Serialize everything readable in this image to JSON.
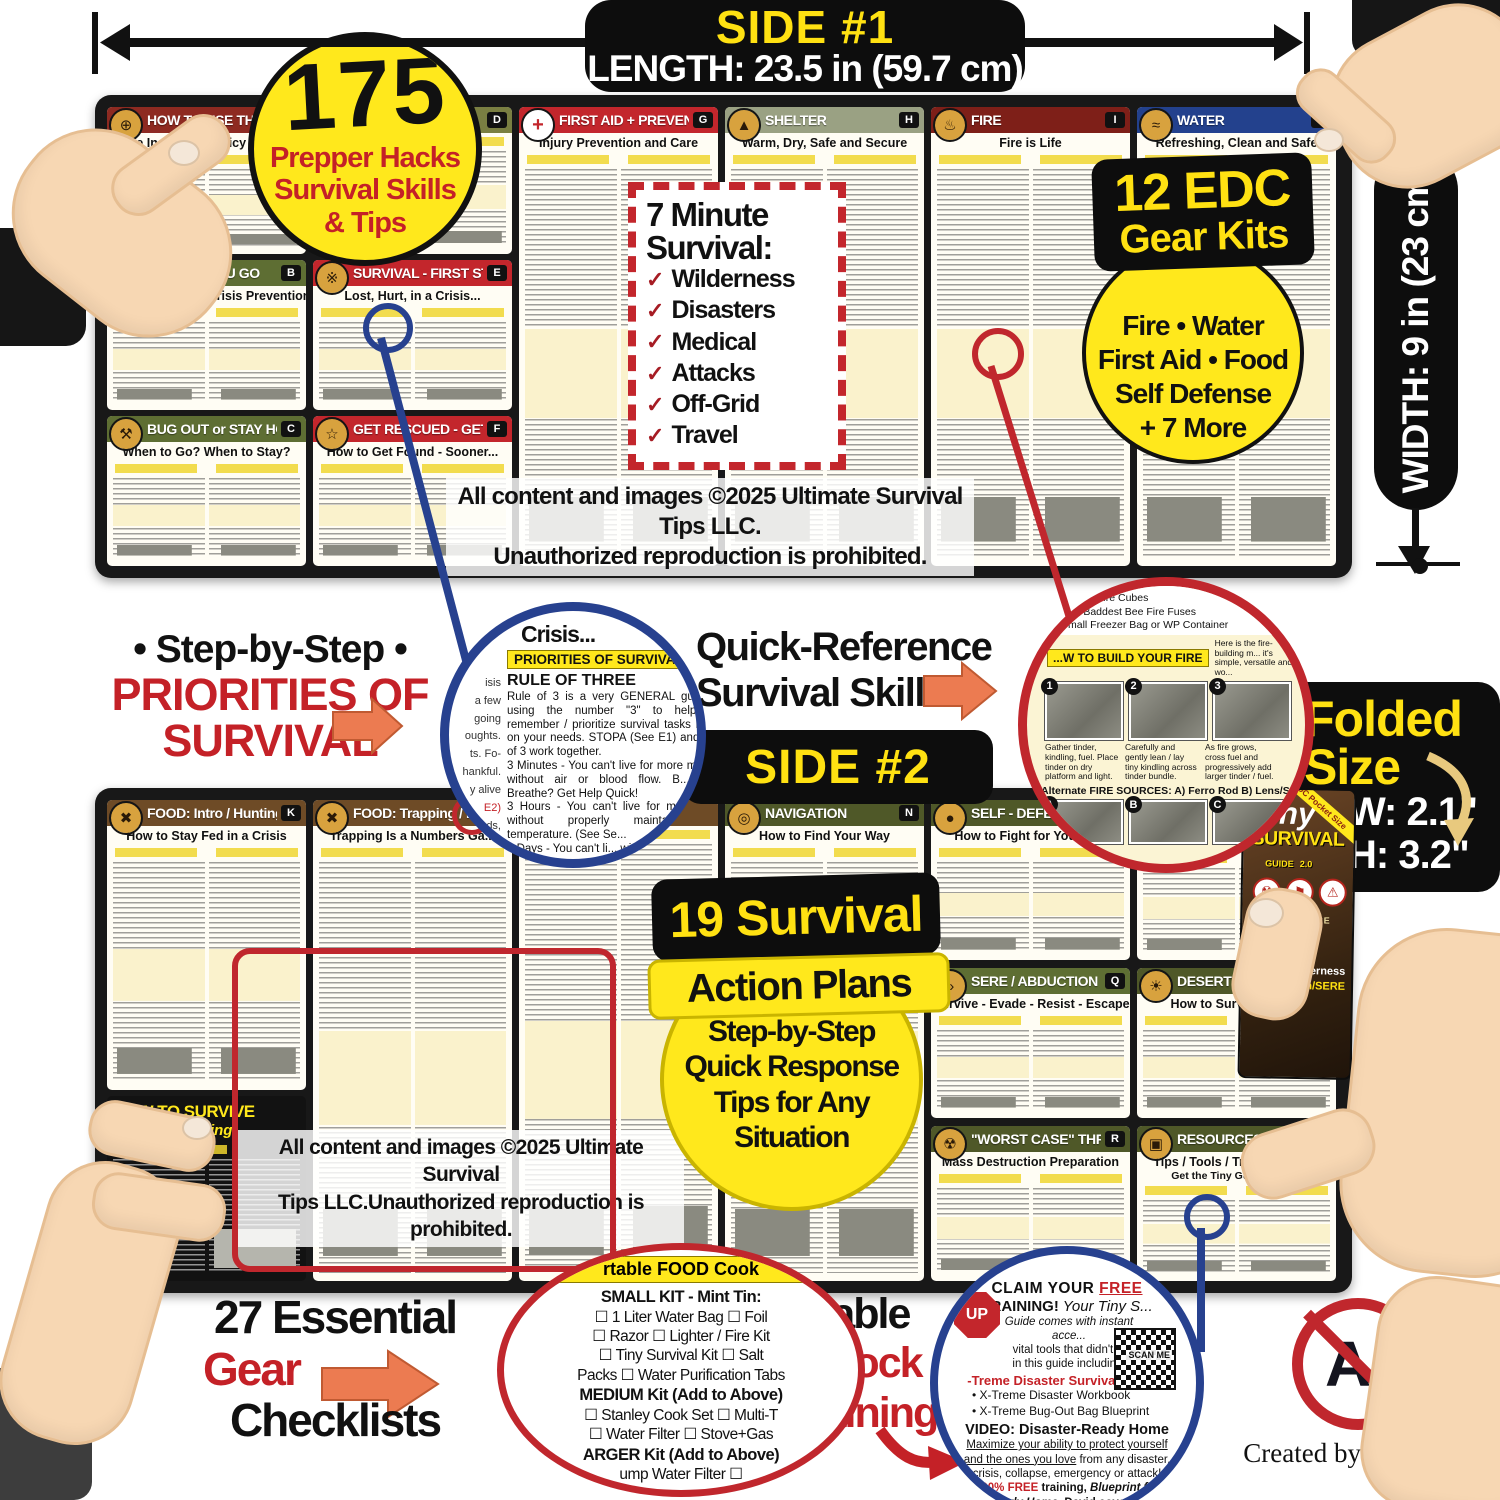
{
  "meas": {
    "side1": "SIDE #1",
    "length": "LENGTH: 23.5 in (59.7 cm)",
    "width": "WIDTH: 9 in (23 cm)",
    "side2": "SIDE #2"
  },
  "badge175": {
    "num": "175",
    "l1": "Prepper Hacks",
    "l2": "Survival Skills",
    "l3": "& Tips"
  },
  "seven": {
    "t1": "7 Minute",
    "t2": "Survival:",
    "items": [
      "Wilderness",
      "Disasters",
      "Medical",
      "Attacks",
      "Off-Grid",
      "Travel"
    ]
  },
  "edc": {
    "t1": "12 EDC",
    "t2": "Gear Kits",
    "l1": "Fire • Water",
    "l2": "First Aid •  Food",
    "l3": "Self Defense",
    "l4": "+ 7 More"
  },
  "copy1a": "All content and images ©2025 Ultimate Survival Tips LLC.",
  "copy1b": "Unauthorized reproduction is prohibited.",
  "copy2a": "All content and images ©2025 Ultimate Survival",
  "copy2b": "Tips LLC.Unauthorized reproduction is prohibited.",
  "p": {
    "a": {
      "t": "HOW TO USE THIS GUIDE",
      "s": "A Life Insurance Policy in Your Pocket",
      "L": "A"
    },
    "d": {
      "L": "D"
    },
    "b": {
      "t": "BEFORE YOU GO",
      "s": "Preparation and Crisis Prevention",
      "L": "B"
    },
    "e": {
      "t": "SURVIVAL - FIRST STEPS",
      "s": "Lost, Hurt, in a Crisis...",
      "L": "E"
    },
    "c": {
      "t": "BUG OUT or STAY HOME",
      "s": "When to Go?   When to Stay?",
      "L": "C"
    },
    "f": {
      "t": "GET RESCUED - GET HOME",
      "s": "How to Get Found - Sooner...",
      "L": "F"
    },
    "g": {
      "t": "FIRST AID + PREVENTION",
      "s": "Injury Prevention and Care",
      "L": "G"
    },
    "h": {
      "t": "SHELTER",
      "s": "Warm, Dry, Safe and Secure",
      "L": "H"
    },
    "i": {
      "t": "FIRE",
      "s": "Fire is Life",
      "L": "I"
    },
    "j": {
      "t": "WATER",
      "s": "Refreshing, Clean and Safe",
      "L": "J"
    },
    "k": {
      "t": "FOOD: Intro / Hunting",
      "s": "How to Stay Fed in a Crisis",
      "L": "K"
    },
    "l": {
      "t": "FOOD: Trapping / Fi...",
      "s": "Trapping Is a Numbers Ga..."
    },
    "n": {
      "t": "NAVIGATION",
      "s": "How to Find Your Way",
      "L": "N"
    },
    "sd": {
      "t": "SELF - DEFENSE",
      "s": "How to Fight for Your Life",
      "tag": "Basics"
    },
    "out": {
      "t": "OUT...",
      "by1": "by David Pelczynski",
      "by2": "with Craig Caudill"
    },
    "q": {
      "t": "SERE / ABDUCTION",
      "s": "Survive - Evade - Resist - Escape",
      "L": "Q"
    },
    "s": {
      "t": "DESERT /ARCTIC",
      "s": "How to Survive Hars...",
      "L": "S"
    },
    "r": {
      "t": "\"WORST CASE\" THREATS",
      "s": "Mass Destruction Preparation",
      "L": "R"
    },
    "t": {
      "t": "RESOURCES",
      "s": "Tips / Tools / Training / Gear",
      "L": "T",
      "extra": "Get the Tiny Guide Trilogy"
    },
    "hts": {
      "t1": "HOW TO SURVIVE",
      "t2": "Almost Anything"
    }
  },
  "step": {
    "l1": "• Step-by-Step •",
    "l2": "PRIORITIES OF",
    "l3": "SURVIVAL"
  },
  "quick": {
    "l1": "Quick-Reference",
    "l2": "Survival Skills"
  },
  "pz": {
    "crisis": "Crisis...",
    "pill": "PRIORITIES OF SURVIVAL",
    "rule": "RULE OF THREE",
    "b1": "Rule of 3 is a very GENERAL guideline using the number \"3\" to help you remember / prioritize survival tasks based on your needs. STOPA (See E1) and Rule of 3 work together.",
    "m1": "3 Minutes - You can't live for more minutes without air or blood flow. B... Can't Breathe? Get Help Quick!",
    "m2": "3 Hours - You can't live for mo... hours without properly mainta... body temperature. (See Se...",
    "m3": "3 Days - You can't li... without wat...",
    "frags": [
      "isis",
      "a few",
      "going",
      "oughts.",
      "ts. Fo-",
      "hankful.",
      "y alive",
      "E2)",
      "eeds,",
      "gths,"
    ]
  },
  "fz": {
    "k1": "...l Fire Cubes",
    "k2": "☐ Baddest Bee Fire Fuses",
    "k3": "Small Freezer Bag or WP Container",
    "kit1": "Emergency",
    "kit2": "Fire Kit",
    "pill": "...W TO BUILD YOUR FIRE",
    "intro1": "Here is the fire-building m...",
    "intro2": "it's simple, versatile and wo...",
    "n1": "1",
    "n2": "2",
    "n3": "3",
    "na": "A",
    "nb": "B",
    "nc": "C",
    "c1": "Gather tinder, kindling, fuel. Place tinder on dry platform and light.",
    "c2": "Carefully and gently lean / lay tiny kindling across tinder bundle.",
    "c3": "As fire grows, cross fuel and progressively add larger tinder / fuel.",
    "alt": "Alternate FIRE SOURCES:  A) Ferro Rod  B) Lens/Sun  C) Wate..."
  },
  "folded": {
    "t1": "Folded",
    "t2": "Size",
    "w": "W: 2.1\"",
    "h": "H: 3.2\""
  },
  "card": {
    "t1": "Tiny",
    "t2": "SURVIVAL",
    "t3": "GUIDE",
    "v": "2.0",
    "ribbon": "EDC Pocket Size",
    "h1": "... INSURANCE",
    "h2": "IN YOUR",
    "h3": "...?",
    "b1": "Wilderness",
    "b2": "rban/SERE"
  },
  "plans": {
    "b1": "19 Survival",
    "b2": "Action Plans",
    "c1": "Step-by-Step",
    "c2": "Quick Response",
    "c3": "Tips for Any",
    "c4": "Situation"
  },
  "gear": {
    "l1": "27 Essential",
    "l2": "Gear",
    "l3": "Checklists"
  },
  "cook": {
    "pill": "rtable FOOD Cook",
    "lines": [
      "SMALL KIT - Mint Tin:",
      "☐ 1 Liter Water Bag ☐ Foil",
      "☐ Razor ☐ Lighter / Fire Kit",
      "☐ Tiny Survival Kit ☐ Salt",
      "Packs ☐ Water Purification Tabs",
      "MEDIUM Kit (Add to Above)",
      "☐ Stanley Cook Set ☐ Multi-T",
      "☐ Water Filter ☐ Stove+Gas",
      "ARGER Kit (Add to Above)",
      "ump Water Filter ☐"
    ]
  },
  "scan": {
    "l1": "24 Scannable",
    "l2a": "Codes: ",
    "l2b": "Unlock",
    "l3": "BONUS Training"
  },
  "claim": {
    "stop": "UP",
    "l1a": "CLAIM YOUR ",
    "l1b": "FREE",
    "l2a": "TRAINING!",
    "l2b": " Your ",
    "l2c": "Tiny S...",
    "l3": "Guide comes with instant acce...",
    "l4": "vital tools that didn't fit",
    "l5": "in this guide including:",
    "bundle": "-Treme Disaster Survival Bundle",
    "w1": "• X-Treme Disaster Workbook",
    "w2": "• X-Treme Bug-Out Bag Blueprint",
    "scanme": "SCAN ME",
    "video": "VIDEO: Disaster-Ready Home",
    "u1": "Maximize your ability to protect yourself",
    "u2a": "and the ones you love",
    "u2b": " from any disaster,",
    "u3": "crisis, collapse, emergency or attack!",
    "f1a": "100% FREE",
    "f1b": " training, ",
    "f1c": "Blueprint for",
    "f2a": "...Ready Home",
    "f2b": ", David covers 3...",
    "bug": "Bug In - Pro's & C..."
  },
  "ai": {
    "label": "AI",
    "credit": "Created by HUMANS"
  }
}
